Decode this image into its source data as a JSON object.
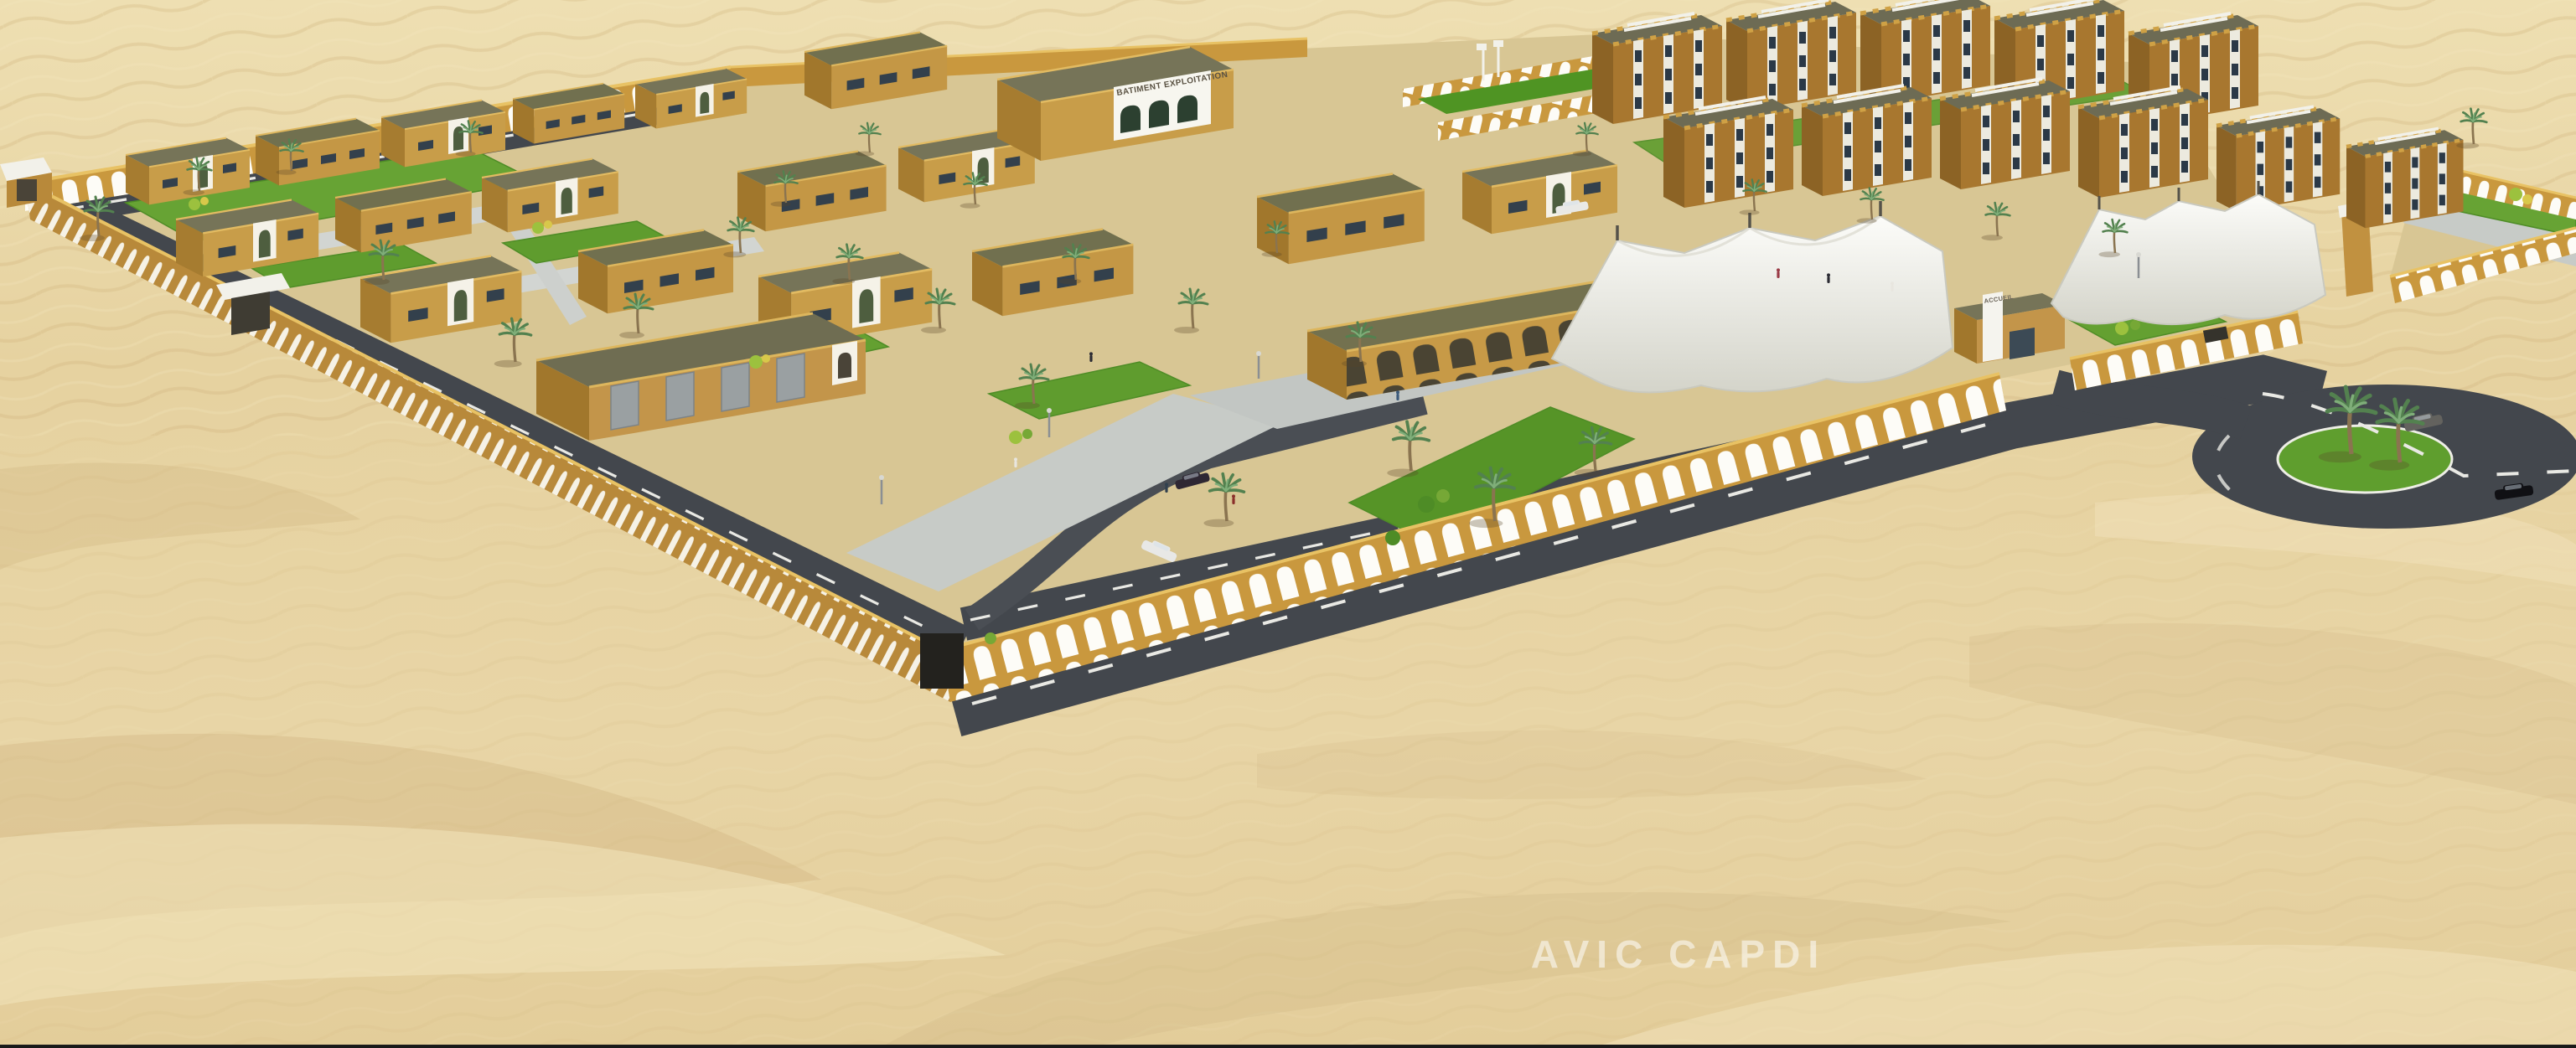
{
  "scene": {
    "type": "architectural-3d-rendering",
    "setting": "aerial perspective of a walled compound in a sand desert",
    "features": [
      "arched perimeter wall",
      "traditional tan flat-roofed buildings with white arched portals",
      "three-story apartment blocks",
      "white tensile shade canopies over parking",
      "internal asphalt roads with dashed markings",
      "palm trees and green lawns",
      "entrance roundabout with two palms and two cars",
      "sports court with green pitch"
    ]
  },
  "signs": {
    "main_building": "BATIMENT EXPLOITATION",
    "gate_building": "ACCUEIL"
  },
  "watermark": {
    "text": "AVIC  CAPDI"
  },
  "palette": {
    "sand": "#e7d4a4",
    "sand_shadow": "#cdb27e",
    "sand_light": "#f2e4bd",
    "wall_tan": "#c9983e",
    "wall_shade": "#a87c30",
    "wall_trim": "#e8c264",
    "arch_white": "#fdfcf7",
    "roof_olive": "#767458",
    "road_asphalt": "#43474d",
    "paving_grey": "#c7cbc7",
    "grass_green": "#62a030",
    "canopy_white": "#f4f4ef",
    "car_grey": "#63625e",
    "car_black": "#101014"
  }
}
